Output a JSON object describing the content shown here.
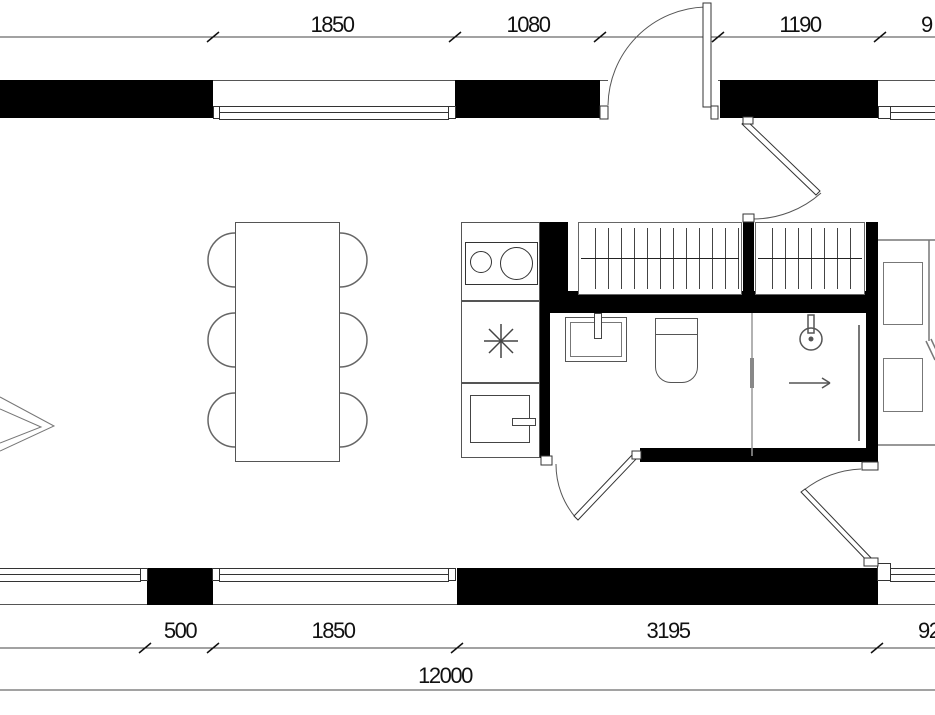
{
  "drawing": {
    "kind": "apartment-floor-plan",
    "colors": {
      "wall": "#000000",
      "line": "#555555",
      "thin": "#777777",
      "text": "#111111",
      "background": "#ffffff"
    }
  },
  "dimensions": {
    "top": [
      {
        "label": "1850"
      },
      {
        "label": "1080"
      },
      {
        "label": "1190"
      },
      {
        "label": "9"
      }
    ],
    "bottom": [
      {
        "label": "500"
      },
      {
        "label": "1850"
      },
      {
        "label": "3195"
      },
      {
        "label": "92"
      }
    ],
    "total": {
      "label": "12000"
    }
  },
  "fixtures": [
    "dining-table",
    "chairs",
    "cooktop",
    "star-symbol",
    "kitchen-sink",
    "wardrobe",
    "bathroom-sink",
    "toilet",
    "shower-head",
    "drain-arrow",
    "shower-glass",
    "bedroom-cabinets"
  ]
}
